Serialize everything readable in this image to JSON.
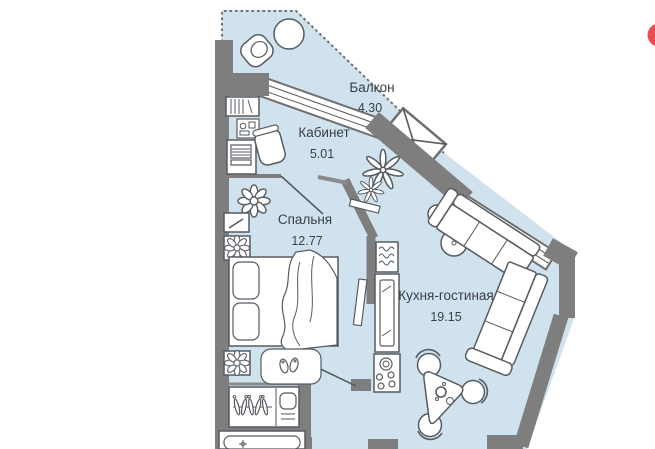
{
  "header": {
    "badge_color": "#ee4a52"
  },
  "plan": {
    "floor_color": "#cfe2ee",
    "wall_color": "#7e7e7e",
    "outline_style": "dashed-balcony-border",
    "rooms": [
      {
        "id": "balcony",
        "name": "Балкон",
        "area": "4.30"
      },
      {
        "id": "office",
        "name": "Кабинет",
        "area": "5.01"
      },
      {
        "id": "bedroom",
        "name": "Спальня",
        "area": "12.77"
      },
      {
        "id": "kitchen-living",
        "name": "Кухня-гостиная",
        "area": "19.15"
      }
    ]
  }
}
